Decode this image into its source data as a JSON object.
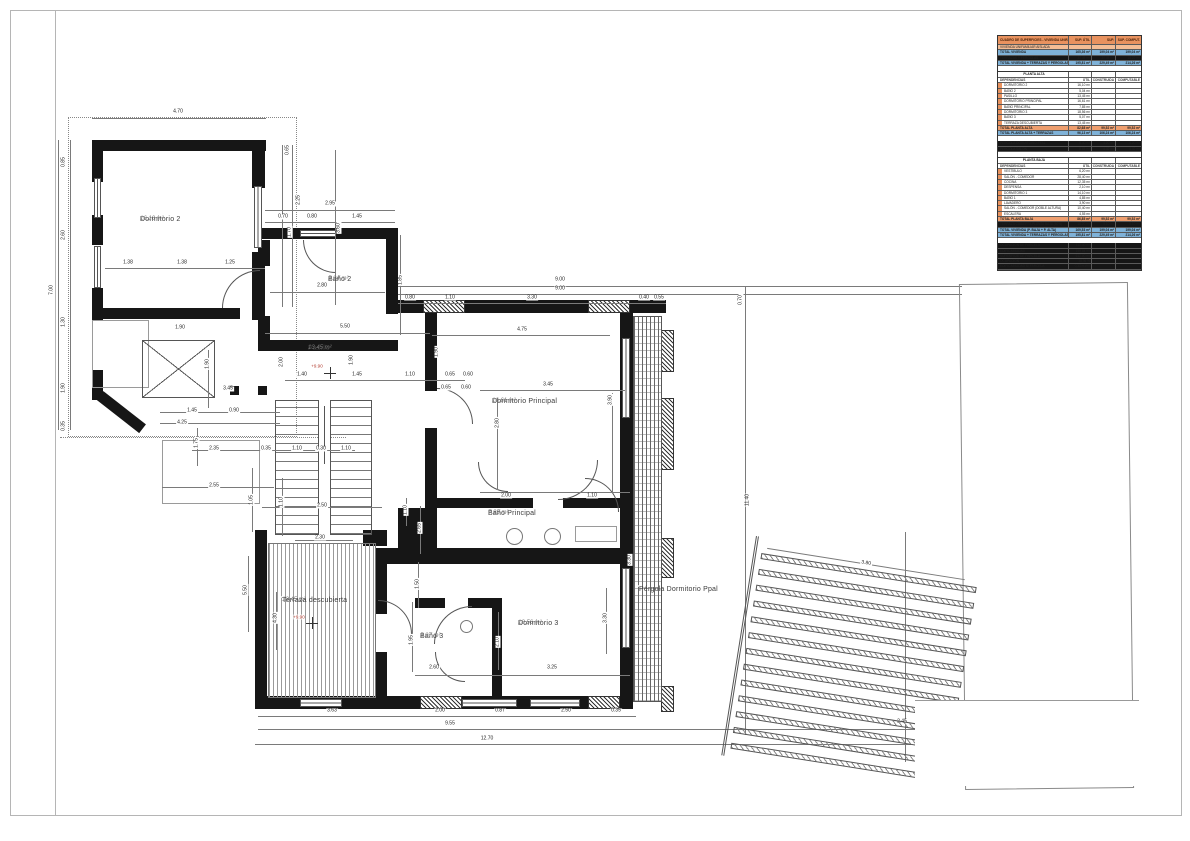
{
  "plan": {
    "rooms": [
      {
        "name": "Dormitorio 2",
        "area": "16.10 m²",
        "x": 140,
        "y": 216,
        "halo": false
      },
      {
        "name": "Baño 2",
        "area": "5.04 m²",
        "x": 328,
        "y": 276,
        "halo": false
      },
      {
        "name": "Pasillo",
        "area": "13.45 m²",
        "x": 308,
        "y": 345,
        "halo": false
      },
      {
        "name": "Dormitorio Principal",
        "area": "16.61 m²",
        "x": 492,
        "y": 398,
        "halo": false
      },
      {
        "name": "Baño Principal",
        "area": "7.85 m²",
        "x": 488,
        "y": 510,
        "halo": false
      },
      {
        "name": "Dormitorio 3",
        "area": "18.56 m²",
        "x": 518,
        "y": 620,
        "halo": false
      },
      {
        "name": "Baño 3",
        "area": "5.07 m²",
        "x": 420,
        "y": 633,
        "halo": false
      },
      {
        "name": "Terraza descubierta",
        "area": "13.45 m²",
        "x": 280,
        "y": 596,
        "halo": true
      },
      {
        "name": "Pérgola Dormitorio Ppal",
        "area": "",
        "x": 637,
        "y": 585,
        "halo": true
      }
    ],
    "dimensions": [
      [
        "4.70",
        178,
        112,
        0
      ],
      [
        "0.85",
        64,
        162,
        1
      ],
      [
        "2.60",
        64,
        235,
        1
      ],
      [
        "1.30",
        64,
        322,
        1
      ],
      [
        "1.90",
        64,
        388,
        1
      ],
      [
        "0.35",
        64,
        426,
        1
      ],
      [
        "7.00",
        52,
        290,
        1
      ],
      [
        "3.60",
        339,
        228,
        1
      ],
      [
        "1.38",
        128,
        263,
        0
      ],
      [
        "1.38",
        182,
        263,
        0
      ],
      [
        "1.25",
        230,
        263,
        0
      ],
      [
        "0.65",
        288,
        150,
        1
      ],
      [
        "2.25",
        299,
        200,
        1
      ],
      [
        "1.70",
        290,
        232,
        1
      ],
      [
        "2.95",
        330,
        204,
        0
      ],
      [
        "0.70",
        283,
        217,
        0
      ],
      [
        "0.80",
        312,
        217,
        0
      ],
      [
        "1.45",
        357,
        217,
        0
      ],
      [
        "2.80",
        322,
        286,
        0
      ],
      [
        "1.85",
        401,
        280,
        1
      ],
      [
        "5.50",
        345,
        327,
        0
      ],
      [
        "2.00",
        282,
        362,
        1
      ],
      [
        "1.90",
        352,
        360,
        1
      ],
      [
        "1.90",
        437,
        352,
        1
      ],
      [
        "1.40",
        302,
        375,
        0
      ],
      [
        "1.45",
        357,
        375,
        0
      ],
      [
        "1.10",
        410,
        375,
        0
      ],
      [
        "0.65",
        450,
        375,
        0
      ],
      [
        "0.60",
        468,
        375,
        0
      ],
      [
        "9.00",
        560,
        280,
        0
      ],
      [
        "9.00",
        560,
        289,
        0
      ],
      [
        "0.80",
        410,
        298,
        0
      ],
      [
        "1.10",
        450,
        298,
        0
      ],
      [
        "3.30",
        532,
        298,
        0
      ],
      [
        "0.40",
        644,
        298,
        0
      ],
      [
        "0.55",
        659,
        298,
        0
      ],
      [
        "0.70",
        741,
        300,
        1
      ],
      [
        "4.75",
        522,
        330,
        0
      ],
      [
        "3.45",
        548,
        385,
        0
      ],
      [
        "2.80",
        498,
        423,
        1
      ],
      [
        "3.90",
        611,
        400,
        1
      ],
      [
        "0.65",
        446,
        388,
        0
      ],
      [
        "0.60",
        466,
        388,
        0
      ],
      [
        "2.00",
        506,
        496,
        0
      ],
      [
        "1.10",
        592,
        496,
        0
      ],
      [
        "1.90",
        180,
        328,
        0
      ],
      [
        "1.90",
        208,
        364,
        1
      ],
      [
        "3.45",
        228,
        389,
        0
      ],
      [
        "1.45",
        192,
        411,
        0
      ],
      [
        "0.90",
        234,
        411,
        0
      ],
      [
        "4.25",
        182,
        423,
        0
      ],
      [
        "1.75",
        197,
        443,
        1
      ],
      [
        "2.35",
        214,
        449,
        0
      ],
      [
        "0.35",
        266,
        449,
        0
      ],
      [
        "1.10",
        297,
        449,
        0
      ],
      [
        "0.30",
        321,
        449,
        0
      ],
      [
        "1.10",
        346,
        449,
        0
      ],
      [
        "2.55",
        214,
        486,
        0
      ],
      [
        "1.05",
        252,
        500,
        1
      ],
      [
        "1.10",
        282,
        502,
        1
      ],
      [
        "2.50",
        322,
        506,
        0
      ],
      [
        "1.10",
        406,
        510,
        1
      ],
      [
        "2.65",
        420,
        528,
        1
      ],
      [
        "1.50",
        418,
        584,
        1
      ],
      [
        "11.40",
        748,
        500,
        1
      ],
      [
        "1.95",
        412,
        640,
        1
      ],
      [
        "2.60",
        434,
        668,
        0
      ],
      [
        "2.10",
        498,
        642,
        1
      ],
      [
        "3.25",
        552,
        668,
        0
      ],
      [
        "3.30",
        606,
        618,
        1
      ],
      [
        "3.30",
        630,
        560,
        1
      ],
      [
        "5.50",
        246,
        590,
        1
      ],
      [
        "4.30",
        276,
        618,
        1
      ],
      [
        "2.30",
        320,
        538,
        0
      ],
      [
        "3.63",
        332,
        711,
        0
      ],
      [
        "2.00",
        440,
        711,
        0
      ],
      [
        "0.87",
        500,
        711,
        0
      ],
      [
        "2.50",
        566,
        711,
        0
      ],
      [
        "0.35",
        616,
        711,
        0
      ],
      [
        "9.55",
        450,
        724,
        0
      ],
      [
        "2.45",
        902,
        722,
        0
      ],
      [
        "12.70",
        487,
        739,
        0
      ]
    ],
    "elevation_marks": [
      {
        "label": "+9.90",
        "x": 317,
        "y": 366,
        "cx": 330,
        "cy": 373
      },
      {
        "label": "+9.90",
        "x": 299,
        "y": 617,
        "cx": 312,
        "cy": 623
      }
    ],
    "pergola_deck_dim": "3.80"
  },
  "table": {
    "rows": [
      [
        "CUADRO DE SUPERFICIES - VIVIENDA UNIFAMILIAR",
        "SUP. ÚTIL",
        "SUP. CONSTR.",
        "SUP. COMPUT.",
        "oh"
      ],
      [
        "VIVIENDA UNIFAMILIAR AISLADA",
        "",
        "",
        "",
        "o"
      ],
      [
        "TOTAL VIVIENDA",
        "165,36 m²",
        "199,04 m²",
        "199,04 m²",
        "b"
      ],
      [
        "TERRAZAS Y PÉRGOLAS",
        "30,45 m²",
        "30,45 m²",
        "15,22 m²",
        "w"
      ],
      [
        "TOTAL VIVIENDA + TERRAZAS Y PÉRGOLAS",
        "195,81 m²",
        "229,49 m²",
        "214,26 m²",
        "b"
      ],
      [
        "",
        "",
        "",
        "",
        "sp"
      ],
      [
        "PLANTA ALTA",
        "",
        "",
        "",
        "sec"
      ],
      [
        "DEPENDENCIAS",
        "ÚTIL",
        "CONSTRUIDA",
        "COMPUTABLE",
        "cols"
      ],
      [
        "DORMITORIO 2",
        "16,10 m²",
        "",
        "",
        "it"
      ],
      [
        "BAÑO 2",
        "5,04 m²",
        "",
        "",
        "it"
      ],
      [
        "PASILLO",
        "13,45 m²",
        "",
        "",
        "it"
      ],
      [
        "DORMITORIO PRINCIPAL",
        "16,61 m²",
        "",
        "",
        "it"
      ],
      [
        "BAÑO PRINCIPAL",
        "7,85 m²",
        "",
        "",
        "it"
      ],
      [
        "DORMITORIO 3",
        "18,56 m²",
        "",
        "",
        "it"
      ],
      [
        "BAÑO 3",
        "5,07 m²",
        "",
        "",
        "it"
      ],
      [
        "TERRAZA DESCUBIERTA",
        "13,45 m²",
        "",
        "",
        "it"
      ],
      [
        "TOTAL PLANTA ALTA",
        "82,68 m²",
        "99,52 m²",
        "99,52 m²",
        "tot"
      ],
      [
        "TOTAL PLANTA ALTA + TERRAZAS",
        "96,13 m²",
        "106,24 m²",
        "106,24 m²",
        "b"
      ],
      [
        "",
        "",
        "",
        "",
        "sp"
      ],
      [
        "PÉRGOLA DORMITORIO PPAL",
        "8,40 m²",
        "4,20 m²",
        "4,20 m²",
        "w"
      ],
      [
        "PÉRGOLA SALÓN",
        "8,65 m²",
        "4,32 m²",
        "4,32 m²",
        "w"
      ],
      [
        "",
        "",
        "",
        "",
        "sp"
      ],
      [
        "PLANTA BAJA",
        "",
        "",
        "",
        "sec"
      ],
      [
        "DEPENDENCIAS",
        "ÚTIL",
        "CONSTRUIDA",
        "COMPUTABLE",
        "cols"
      ],
      [
        "VESTÍBULO",
        "6,20 m²",
        "",
        "",
        "it"
      ],
      [
        "SALÓN - COMEDOR",
        "28,40 m²",
        "",
        "",
        "it"
      ],
      [
        "COCINA",
        "12,35 m²",
        "",
        "",
        "it"
      ],
      [
        "DESPENSA",
        "2,10 m²",
        "",
        "",
        "it"
      ],
      [
        "DORMITORIO 1",
        "14,10 m²",
        "",
        "",
        "it"
      ],
      [
        "BAÑO 1",
        "4,85 m²",
        "",
        "",
        "it"
      ],
      [
        "LAVADERO",
        "3,90 m²",
        "",
        "",
        "it"
      ],
      [
        "SALÓN - COMEDOR (DOBLE ALTURA)",
        "10,40 m²",
        "",
        "",
        "it"
      ],
      [
        "ESCALERA",
        "4,55 m²",
        "",
        "",
        "it"
      ],
      [
        "TOTAL PLANTA BAJA",
        "86,85 m²",
        "99,52 m²",
        "99,52 m²",
        "tot"
      ],
      [
        "TERRAZA CUBIERTA PLANTA BAJA (50%)",
        "18,20 m²",
        "9,10 m²",
        "9,10 m²",
        "w"
      ],
      [
        "TOTAL VIVIENDA (P. BAJA + P. ALTA)",
        "169,53 m²",
        "199,04 m²",
        "199,04 m²",
        "b"
      ],
      [
        "TOTAL VIVIENDA + TERRAZAS Y PÉRGOLAS",
        "195,81 m²",
        "229,49 m²",
        "214,26 m²",
        "b"
      ],
      [
        "",
        "",
        "",
        "",
        "sp"
      ],
      [
        "OCUPACIÓN DE PARCELA",
        "112,40 m²",
        "",
        "",
        "w"
      ],
      [
        "EDIFICABILIDAD",
        "199,04 m²",
        "",
        "",
        "w"
      ],
      [
        "SUPERFICIE DE PARCELA",
        "612,00 m²",
        "",
        "",
        "w"
      ],
      [
        "OCUPACIÓN",
        "18,36 %",
        "",
        "",
        "w"
      ],
      [
        "EDIFICABILIDAD S/ PARCELA",
        "0,33 m²/m²",
        "",
        "",
        "w"
      ]
    ]
  }
}
